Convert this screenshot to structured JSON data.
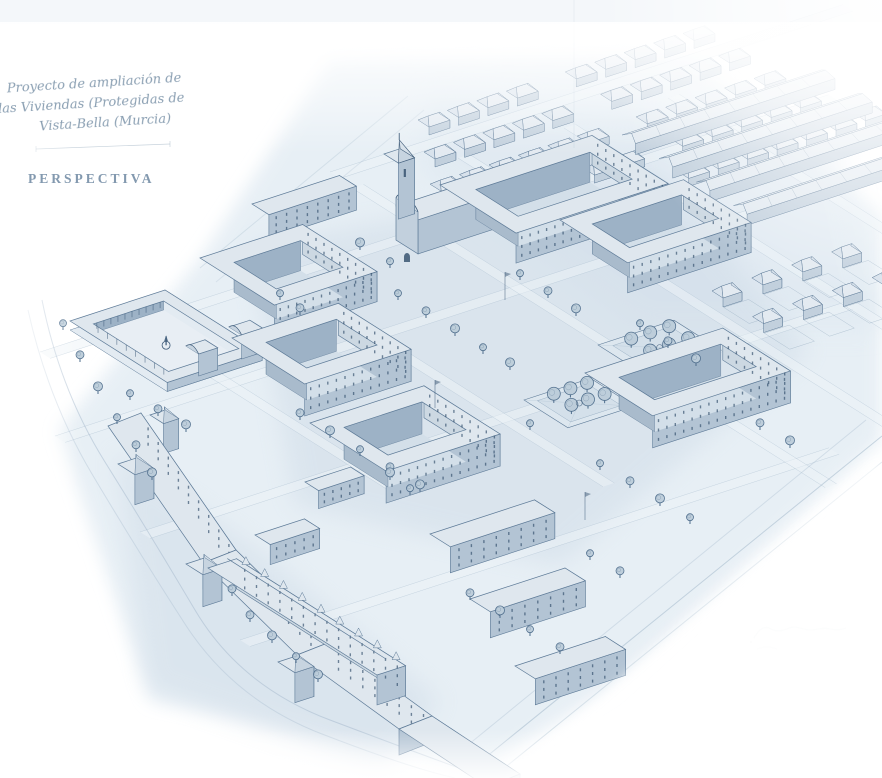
{
  "drawing": {
    "title_block": {
      "lines": [
        "Proyecto de ampliación de",
        "las Viviendas (Protegidas de",
        "Vista-Bella (Murcia)"
      ]
    },
    "stamp": {
      "label": "PERSPECTIVA"
    },
    "palette": {
      "paper": "#ffffff",
      "wash_light": "#e0eaf2",
      "wash_mid": "#c9d7e4",
      "roof": "#dfe7ee",
      "wall_shaded": "#b3c4d4",
      "wall_lit": "#ccd8e2",
      "ink_line": "#5d7a97",
      "ink_dark": "#2f4c69",
      "handwriting_ink": "#7f96ab",
      "stamp_ink": "#6e88a2"
    }
  }
}
